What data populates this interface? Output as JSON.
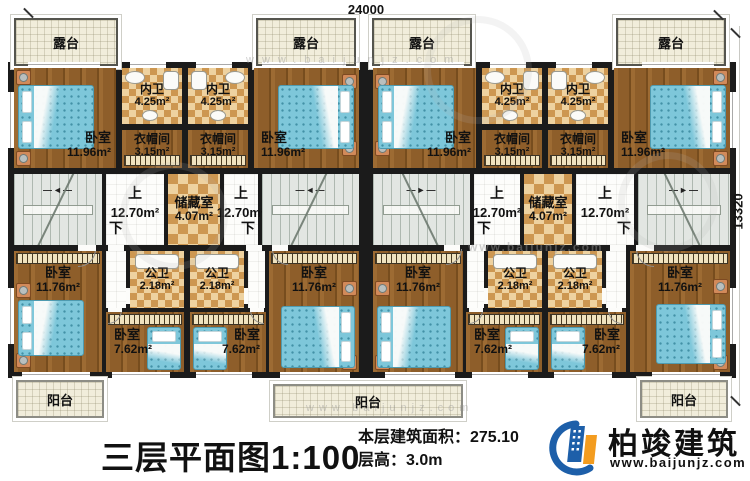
{
  "plan": {
    "dim_top": "24000",
    "dim_right": "13320",
    "labels": {
      "terrace": "露台",
      "balcony": "阳台",
      "bedroom": "卧室",
      "inner_bath": "内卫",
      "cloakroom": "衣帽间",
      "storage": "储藏室",
      "public_bath": "公卫",
      "up": "上",
      "down": "下",
      "stair_arrow_left": "—◄—",
      "stair_arrow_right": "—►—"
    },
    "areas": {
      "bedroom_large": "11.96m²",
      "inner_bath": "4.25m²",
      "cloakroom": "3.15m²",
      "stair": "12.70m²",
      "storage": "4.07m²",
      "public_bath": "2.18m²",
      "bedroom_mid": "11.76m²",
      "bedroom_small": "7.62m²"
    }
  },
  "watermark": {
    "site": "www.baijunjz.com"
  },
  "footer": {
    "title": "三层平面图1:100",
    "area_line": "本层建筑面积：275.10",
    "height_line": "层高：3.0m",
    "brand": "柏竣建筑",
    "website": "www.baijunjz.com"
  },
  "colors": {
    "wall": "#1b1b1b",
    "terrace": "#f1eddb",
    "stair": "#e2e6e2",
    "checker_light": "#eed2a0",
    "checker_dark": "#cd9751",
    "bed": "#7ec7da",
    "nightstand": "#d28a5a",
    "logo_blue": "#1d5fa9",
    "logo_orange": "#f39c1f"
  }
}
